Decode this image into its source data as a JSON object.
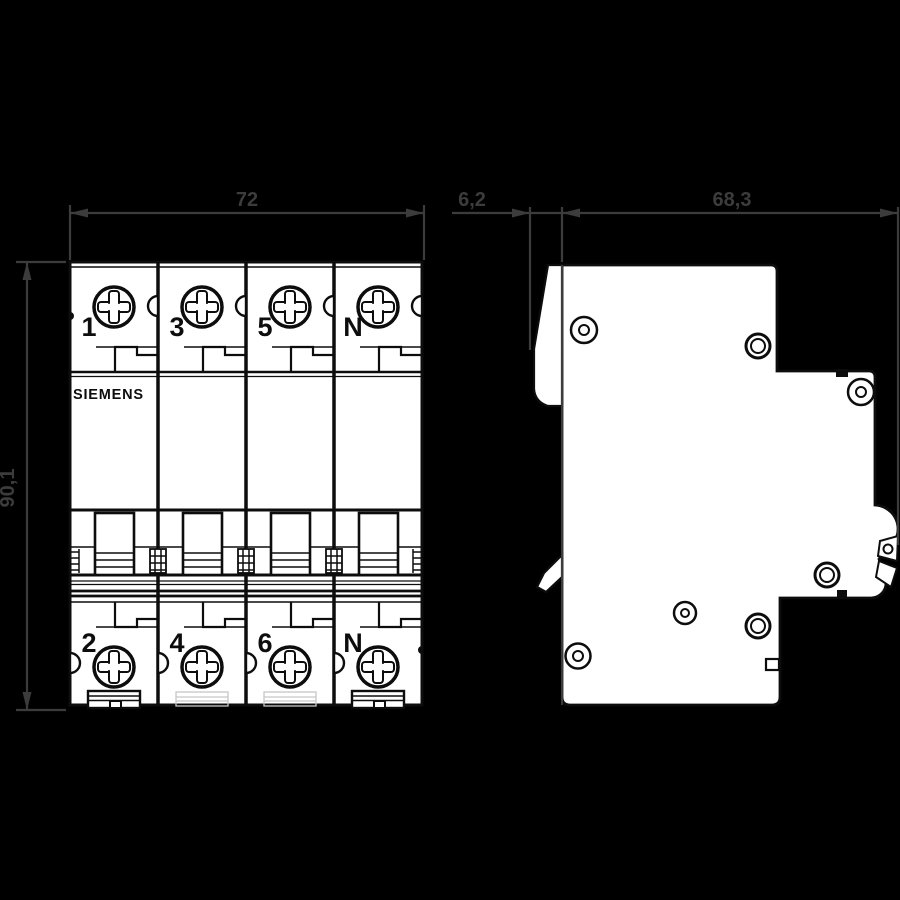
{
  "drawing": {
    "brand": "SIEMENS",
    "front": {
      "width_mm": "72",
      "height_mm": "90,1",
      "pole_labels_top": [
        "1",
        "3",
        "5",
        "N"
      ],
      "pole_labels_bottom": [
        "2",
        "4",
        "6",
        "N"
      ]
    },
    "side": {
      "rail_offset_mm": "6,2",
      "depth_mm": "68,3"
    },
    "colors": {
      "background": "#000000",
      "body_fill": "#ffffff",
      "outline": "#0d0d0d",
      "dimension": "#3c3c3c"
    }
  }
}
